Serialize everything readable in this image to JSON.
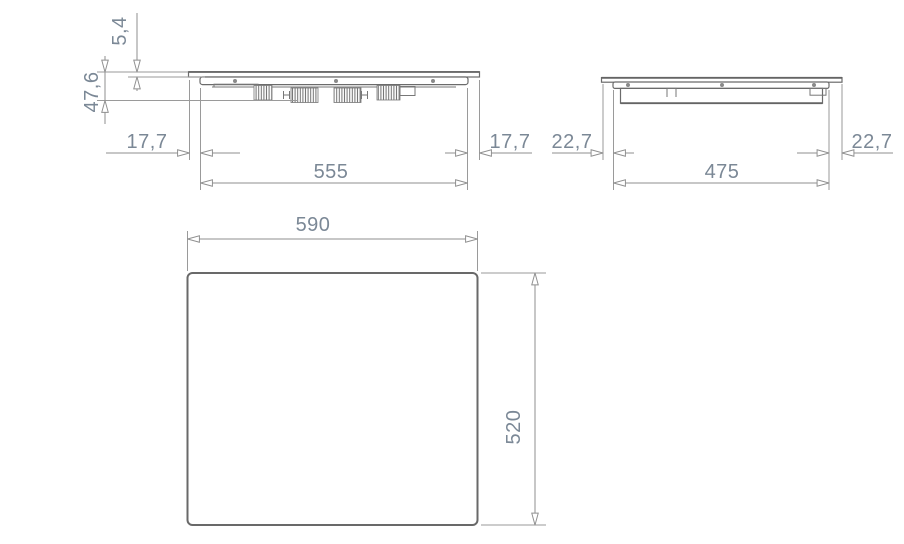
{
  "drawing": {
    "title": "cooktop-dimension-drawing",
    "front_view": {
      "glass_thickness": "5,4",
      "install_height": "47,6",
      "left_overhang": "17,7",
      "body_width": "555",
      "right_overhang": "17,7"
    },
    "side_view": {
      "left_overhang": "22,7",
      "body_depth": "475",
      "right_overhang": "22,7"
    },
    "top_view": {
      "width": "590",
      "depth": "520"
    }
  },
  "colors": {
    "background": "#ffffff",
    "outline": "#6b6b6b",
    "dimension_line": "#8f8f8f",
    "label_text": "#7b8896"
  }
}
